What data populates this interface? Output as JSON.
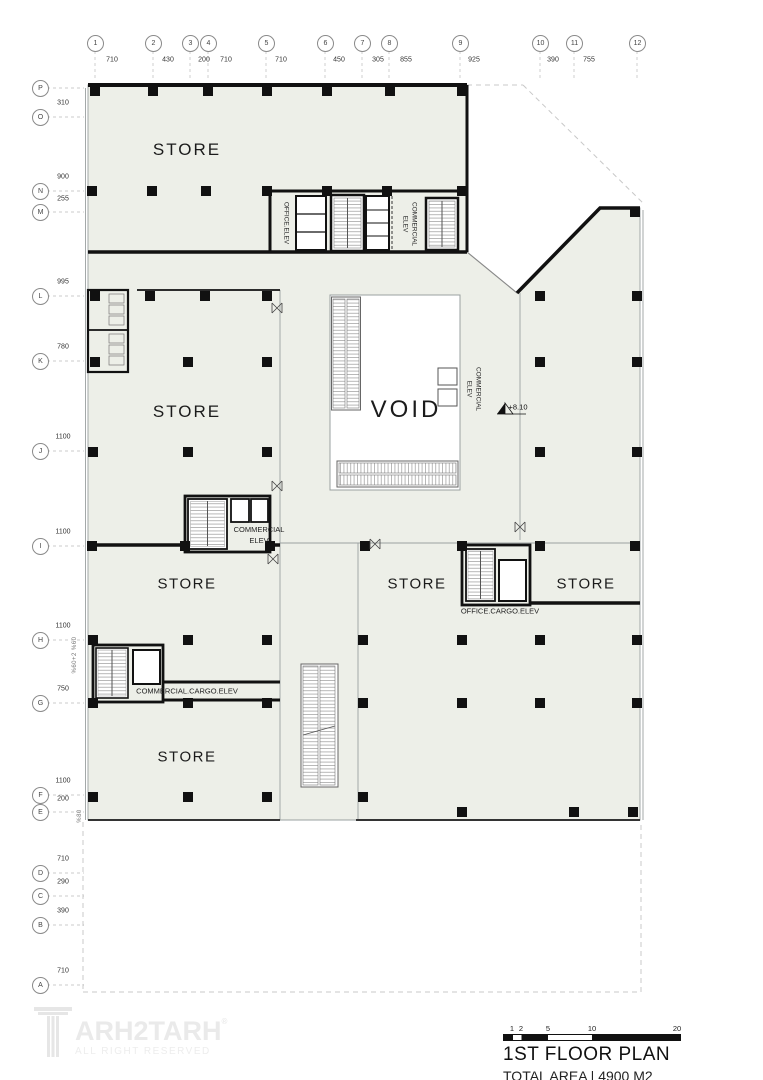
{
  "grid": {
    "top": {
      "bubbles": [
        "1",
        "2",
        "3",
        "4",
        "5",
        "6",
        "7",
        "8",
        "9",
        "10",
        "11",
        "12"
      ],
      "dims": [
        "710",
        "430",
        "200",
        "710",
        "710",
        "450",
        "305",
        "855",
        "925",
        "390",
        "755"
      ]
    },
    "left": {
      "bubbles": [
        "P",
        "O",
        "N",
        "M",
        "L",
        "K",
        "J",
        "I",
        "H",
        "G",
        "F",
        "E",
        "D",
        "C",
        "B",
        "A"
      ],
      "dims": [
        "310",
        "900",
        "255",
        "995",
        "780",
        "1100",
        "1100",
        "1100",
        "750",
        "1100",
        "200",
        "710",
        "290",
        "390",
        "710"
      ]
    }
  },
  "rooms": {
    "store_label": "STORE",
    "void_label": "VOID"
  },
  "labels": {
    "office_elev": "OFFICE.ELEV",
    "commercial": "COMMERCIAL",
    "elev": "ELEV",
    "office_cargo_elev": "OFFICE.CARGO.ELEV",
    "commercial_cargo_elev": "COMMERCIAL.CARGO.ELEV",
    "level": "+8.10",
    "ramp_a": "%60+2 %60",
    "ramp_b": "%80"
  },
  "titleblock": {
    "title": "1ST FLOOR PLAN",
    "subtitle": "TOTAL AREA | 4900 M2",
    "scale_ticks": [
      "1",
      "2",
      "5",
      "10",
      "20"
    ]
  },
  "logo": {
    "brand_text": "ARH2TARH",
    "registered": "®",
    "tagline": "ALL RIGHT RESERVED"
  },
  "colors": {
    "plan_fill": "#edefe8",
    "wall": "#111111",
    "thin_line": "#9aa0a0",
    "dashed_line": "#c8c8c8",
    "logo_gray": "#eaeaea"
  }
}
